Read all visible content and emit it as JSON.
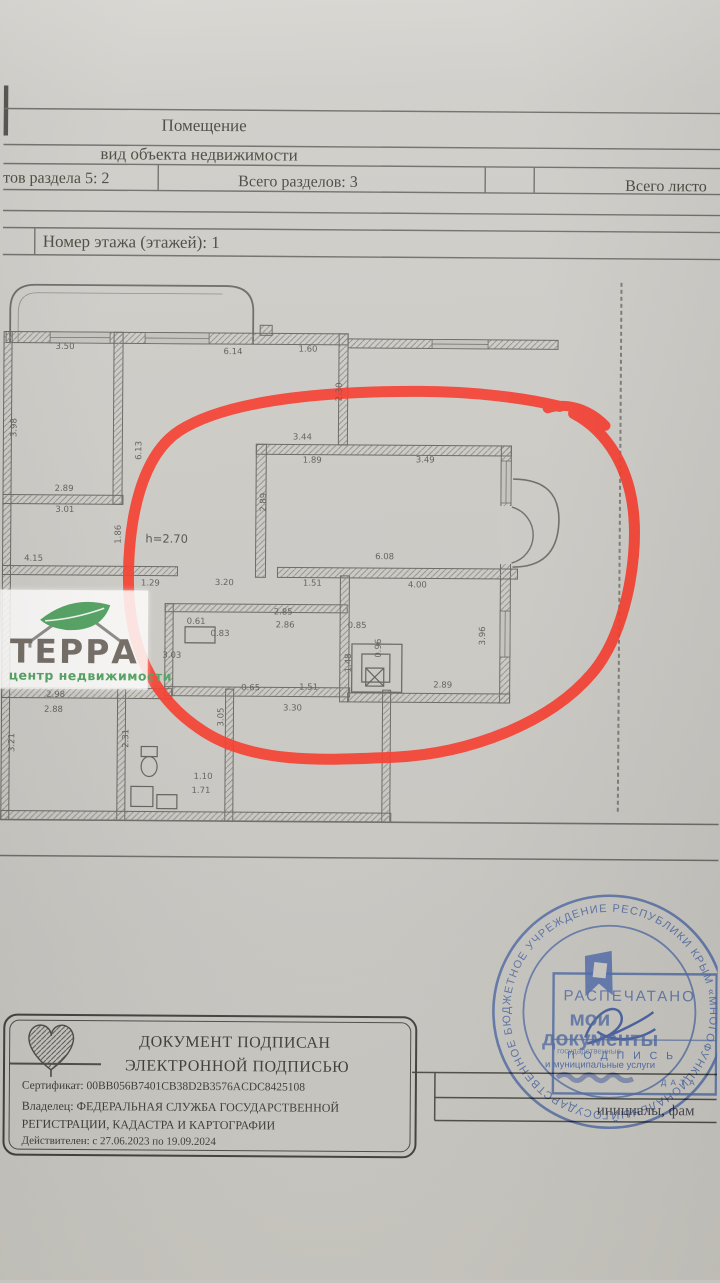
{
  "header": {
    "title": "Помещение",
    "subtitle": "вид объекта недвижимости",
    "cell_section_sheets": "тов раздела 5: 2",
    "cell_total_sections": "Всего разделов: 3",
    "cell_total_sheets": "Всего листо",
    "floor_row": "Номер этажа (этажей): 1"
  },
  "floor_plan": {
    "dimensions": [
      {
        "t": "3.50",
        "x": 63,
        "y": 349
      },
      {
        "t": "6.14",
        "x": 231,
        "y": 353
      },
      {
        "t": "1.60",
        "x": 306,
        "y": 350
      },
      {
        "t": "2.30",
        "x": 338,
        "y": 392,
        "r": 1
      },
      {
        "t": "3.98",
        "x": 13,
        "y": 430,
        "r": 1
      },
      {
        "t": "6.13",
        "x": 138,
        "y": 452,
        "r": 1
      },
      {
        "t": "2.89",
        "x": 63,
        "y": 491
      },
      {
        "t": "3.01",
        "x": 64,
        "y": 512
      },
      {
        "t": "1.86",
        "x": 118,
        "y": 536,
        "r": 1
      },
      {
        "t": "h=2.70",
        "x": 166,
        "y": 540,
        "big": 1
      },
      {
        "t": "3.44",
        "x": 301,
        "y": 438
      },
      {
        "t": "1.89",
        "x": 311,
        "y": 461
      },
      {
        "t": "3.49",
        "x": 424,
        "y": 460
      },
      {
        "t": "2.89",
        "x": 263,
        "y": 503,
        "r": 1
      },
      {
        "t": "6.08",
        "x": 384,
        "y": 557
      },
      {
        "t": "4.15",
        "x": 33,
        "y": 561
      },
      {
        "t": "1.29",
        "x": 150,
        "y": 585
      },
      {
        "t": "3.20",
        "x": 224,
        "y": 584
      },
      {
        "t": "1.51",
        "x": 312,
        "y": 584
      },
      {
        "t": "4.00",
        "x": 417,
        "y": 585
      },
      {
        "t": "2.85",
        "x": 283,
        "y": 613
      },
      {
        "t": "2.86",
        "x": 285,
        "y": 626
      },
      {
        "t": "0.61",
        "x": 196,
        "y": 623
      },
      {
        "t": "0.83",
        "x": 220,
        "y": 635
      },
      {
        "t": "3.03",
        "x": 172,
        "y": 657
      },
      {
        "t": "0.85",
        "x": 357,
        "y": 626
      },
      {
        "t": "0.96",
        "x": 379,
        "y": 648,
        "r": 1
      },
      {
        "t": "1.48",
        "x": 349,
        "y": 663,
        "r": 1
      },
      {
        "t": "3.96",
        "x": 483,
        "y": 635,
        "r": 1
      },
      {
        "t": "2.89",
        "x": 443,
        "y": 685
      },
      {
        "t": "0.65",
        "x": 251,
        "y": 689
      },
      {
        "t": "1.51",
        "x": 309,
        "y": 688
      },
      {
        "t": "3.30",
        "x": 293,
        "y": 709
      },
      {
        "t": "2.98",
        "x": 56,
        "y": 697
      },
      {
        "t": "2.88",
        "x": 54,
        "y": 712
      },
      {
        "t": "2.31",
        "x": 127,
        "y": 740,
        "r": 1
      },
      {
        "t": "3.05",
        "x": 222,
        "y": 718,
        "r": 1
      },
      {
        "t": "3.21",
        "x": 13,
        "y": 745,
        "r": 1
      },
      {
        "t": "1.10",
        "x": 204,
        "y": 778
      },
      {
        "t": "1.71",
        "x": 202,
        "y": 792
      }
    ]
  },
  "watermark": {
    "name": "ТЕРРА",
    "subtitle": "центр недвижимости"
  },
  "stamp": {
    "ring_text": "ГОСУДАРСТВЕННОЕ БЮДЖЕТНОЕ УЧРЕЖДЕНИЕ РЕСПУБЛИКИ КРЫМ «МНОГОФУНКЦИОНАЛЬНЫЙ ЦЕНТР ПРЕДОСТАВЛЕНИЯ ГОСУДАРСТВЕННЫХ И МУНИЦИПАЛЬНЫХ УСЛУГ»",
    "printed": "РАСПЕЧАТАНО",
    "brand_line1": "мои",
    "brand_line2": "документы",
    "signature_label": "П О Д П И С Ь",
    "services_line": "и муниципальные услуги",
    "services_line_small": "государственные",
    "date_label": "Д А Т А",
    "caption": "инициалы, фам"
  },
  "signature_block": {
    "line1": "ДОКУМЕНТ ПОДПИСАН",
    "line2": "ЭЛЕКТРОННОЙ ПОДПИСЬЮ",
    "certificate": "Сертификат: 00BB056B7401CB38D2B3576ACDC8425108",
    "owner_line1": "Владелец: ФЕДЕРАЛЬНАЯ СЛУЖБА ГОСУДАРСТВЕННОЙ",
    "owner_line2": "РЕГИСТРАЦИИ, КАДАСТРА И КАРТОГРАФИИ",
    "validity": "Действителен: с 27.06.2023 по 19.09.2024"
  },
  "colors": {
    "paper": "#cac8c3",
    "table_line": "#6f6e6a",
    "plan_line": "#66655f",
    "ink": "#3d3d3a",
    "red_marker": "#f4382a",
    "stamp_blue": "#43609f",
    "logo_green": "#4f9e5d",
    "logo_text": "#6f6861"
  }
}
